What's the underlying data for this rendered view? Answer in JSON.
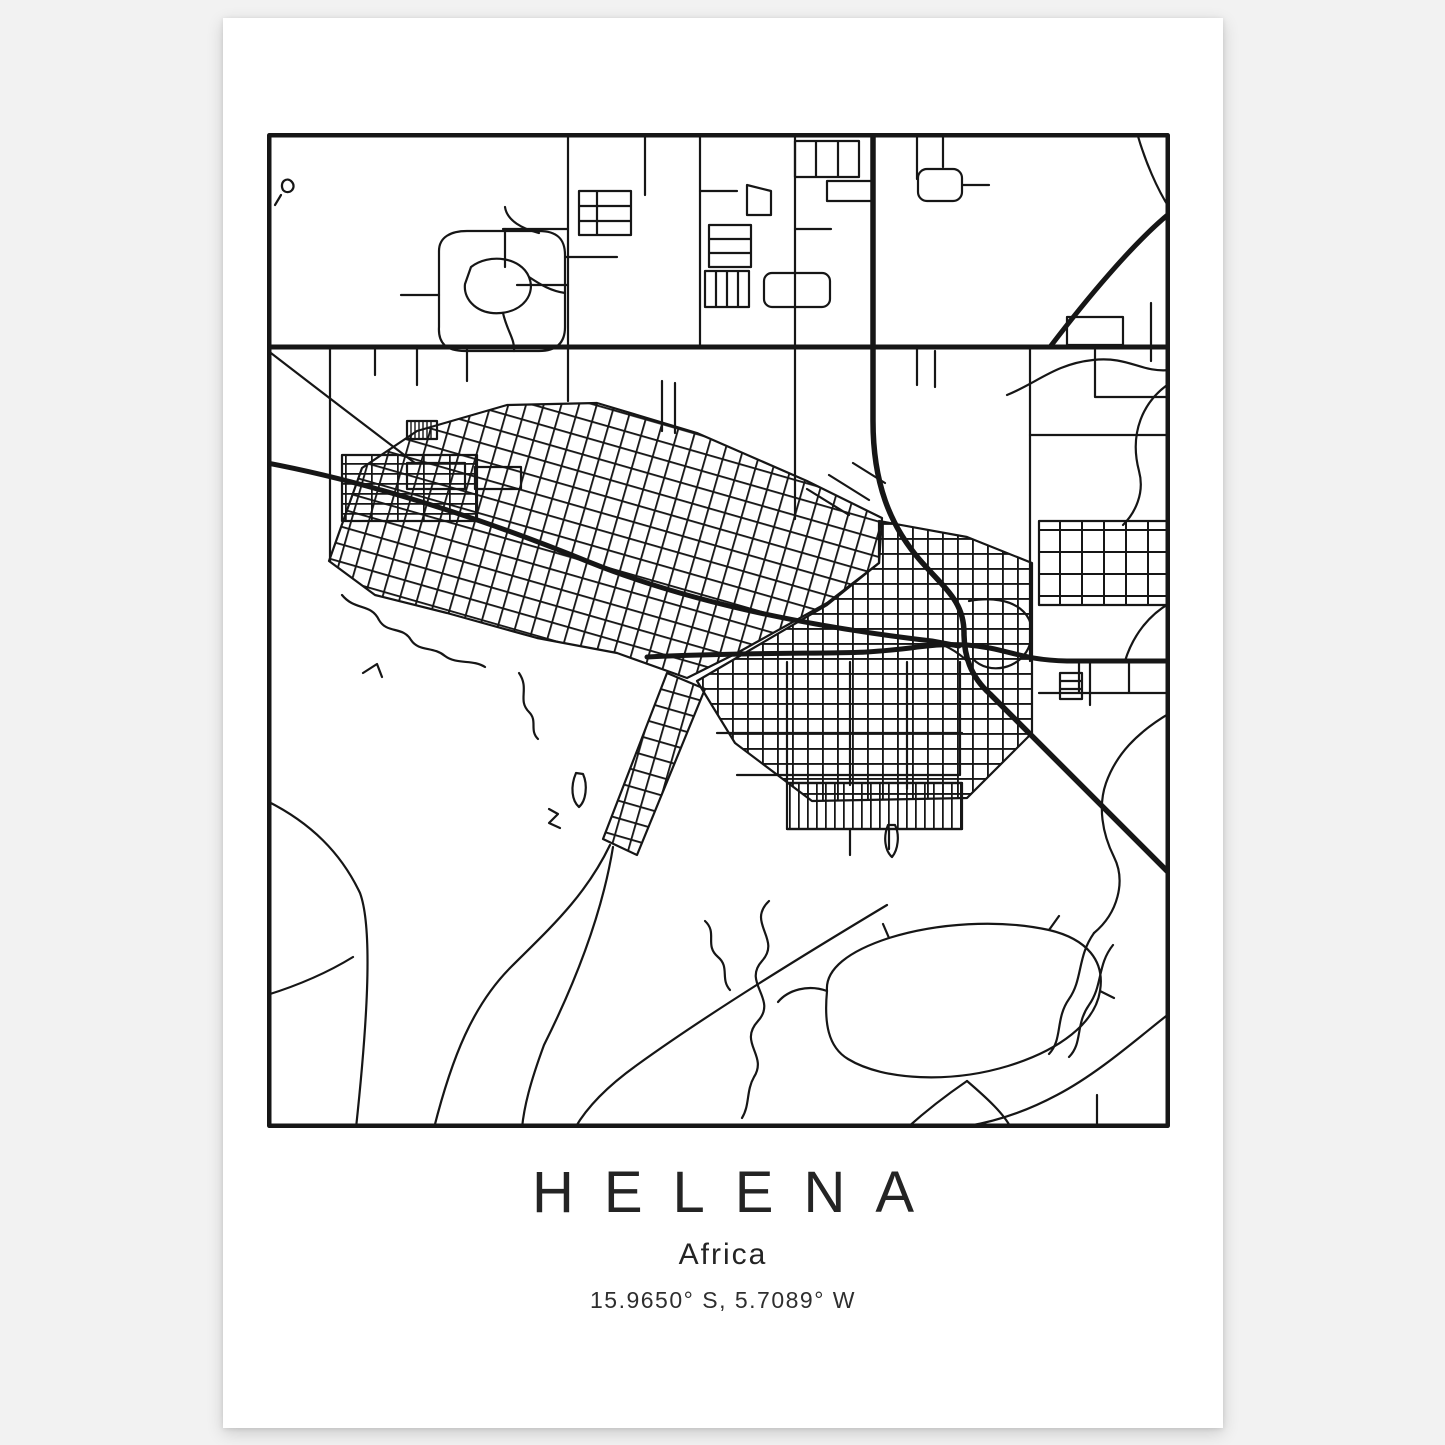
{
  "poster": {
    "title": "HELENA",
    "subtitle": "Africa",
    "coordinates": "15.9650° S, 5.7089° W"
  },
  "map": {
    "name": "Helena city street map",
    "style": "minimal black-and-white line map in a square frame"
  },
  "colors": {
    "page_background": "#f2f2f2",
    "paper": "#ffffff",
    "ink": "#161616"
  }
}
